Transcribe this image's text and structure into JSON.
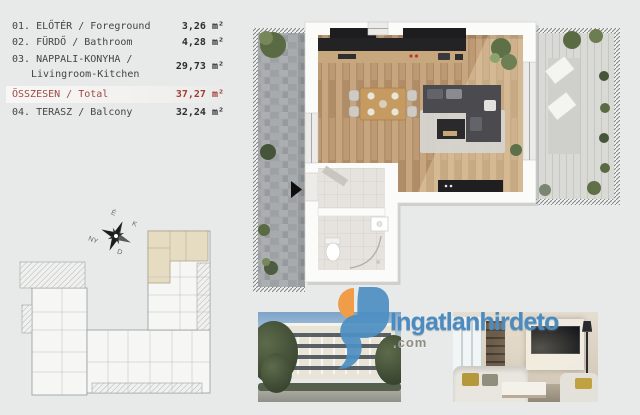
{
  "legend": {
    "rows": [
      {
        "line1": "01. ELŐTÉR / Foreground",
        "line2": "",
        "value": "3,26 m²"
      },
      {
        "line1": "02. FÜRDŐ / Bathroom",
        "line2": "",
        "value": "4,28 m²"
      },
      {
        "line1": "03. NAPPALI-KONYHA /",
        "line2": "Livingroom-Kitchen",
        "value": "29,73 m²"
      },
      {
        "line1": "ÖSSZESEN / Total",
        "line2": "",
        "value": "37,27 m²"
      },
      {
        "line1": "04. TERASZ / Balcony",
        "line2": "",
        "value": "32,24 m²"
      }
    ]
  },
  "compass": {
    "north": "É",
    "east": "K",
    "south": "D",
    "west": "NY"
  },
  "logo": {
    "brand": "Ingatlanhirdeto",
    "tld": ".com"
  },
  "icons": {
    "compass_rose": "compass-rose-icon",
    "entrance_arrow": "▶"
  },
  "colors": {
    "background": "#e8e9e9",
    "total_accent": "#9e4a42",
    "logo_blue": "#4a8bc0",
    "logo_orange": "#f09d49",
    "highlight_unit": "#e5dcc1",
    "wood_floor": "#bd9a74"
  }
}
